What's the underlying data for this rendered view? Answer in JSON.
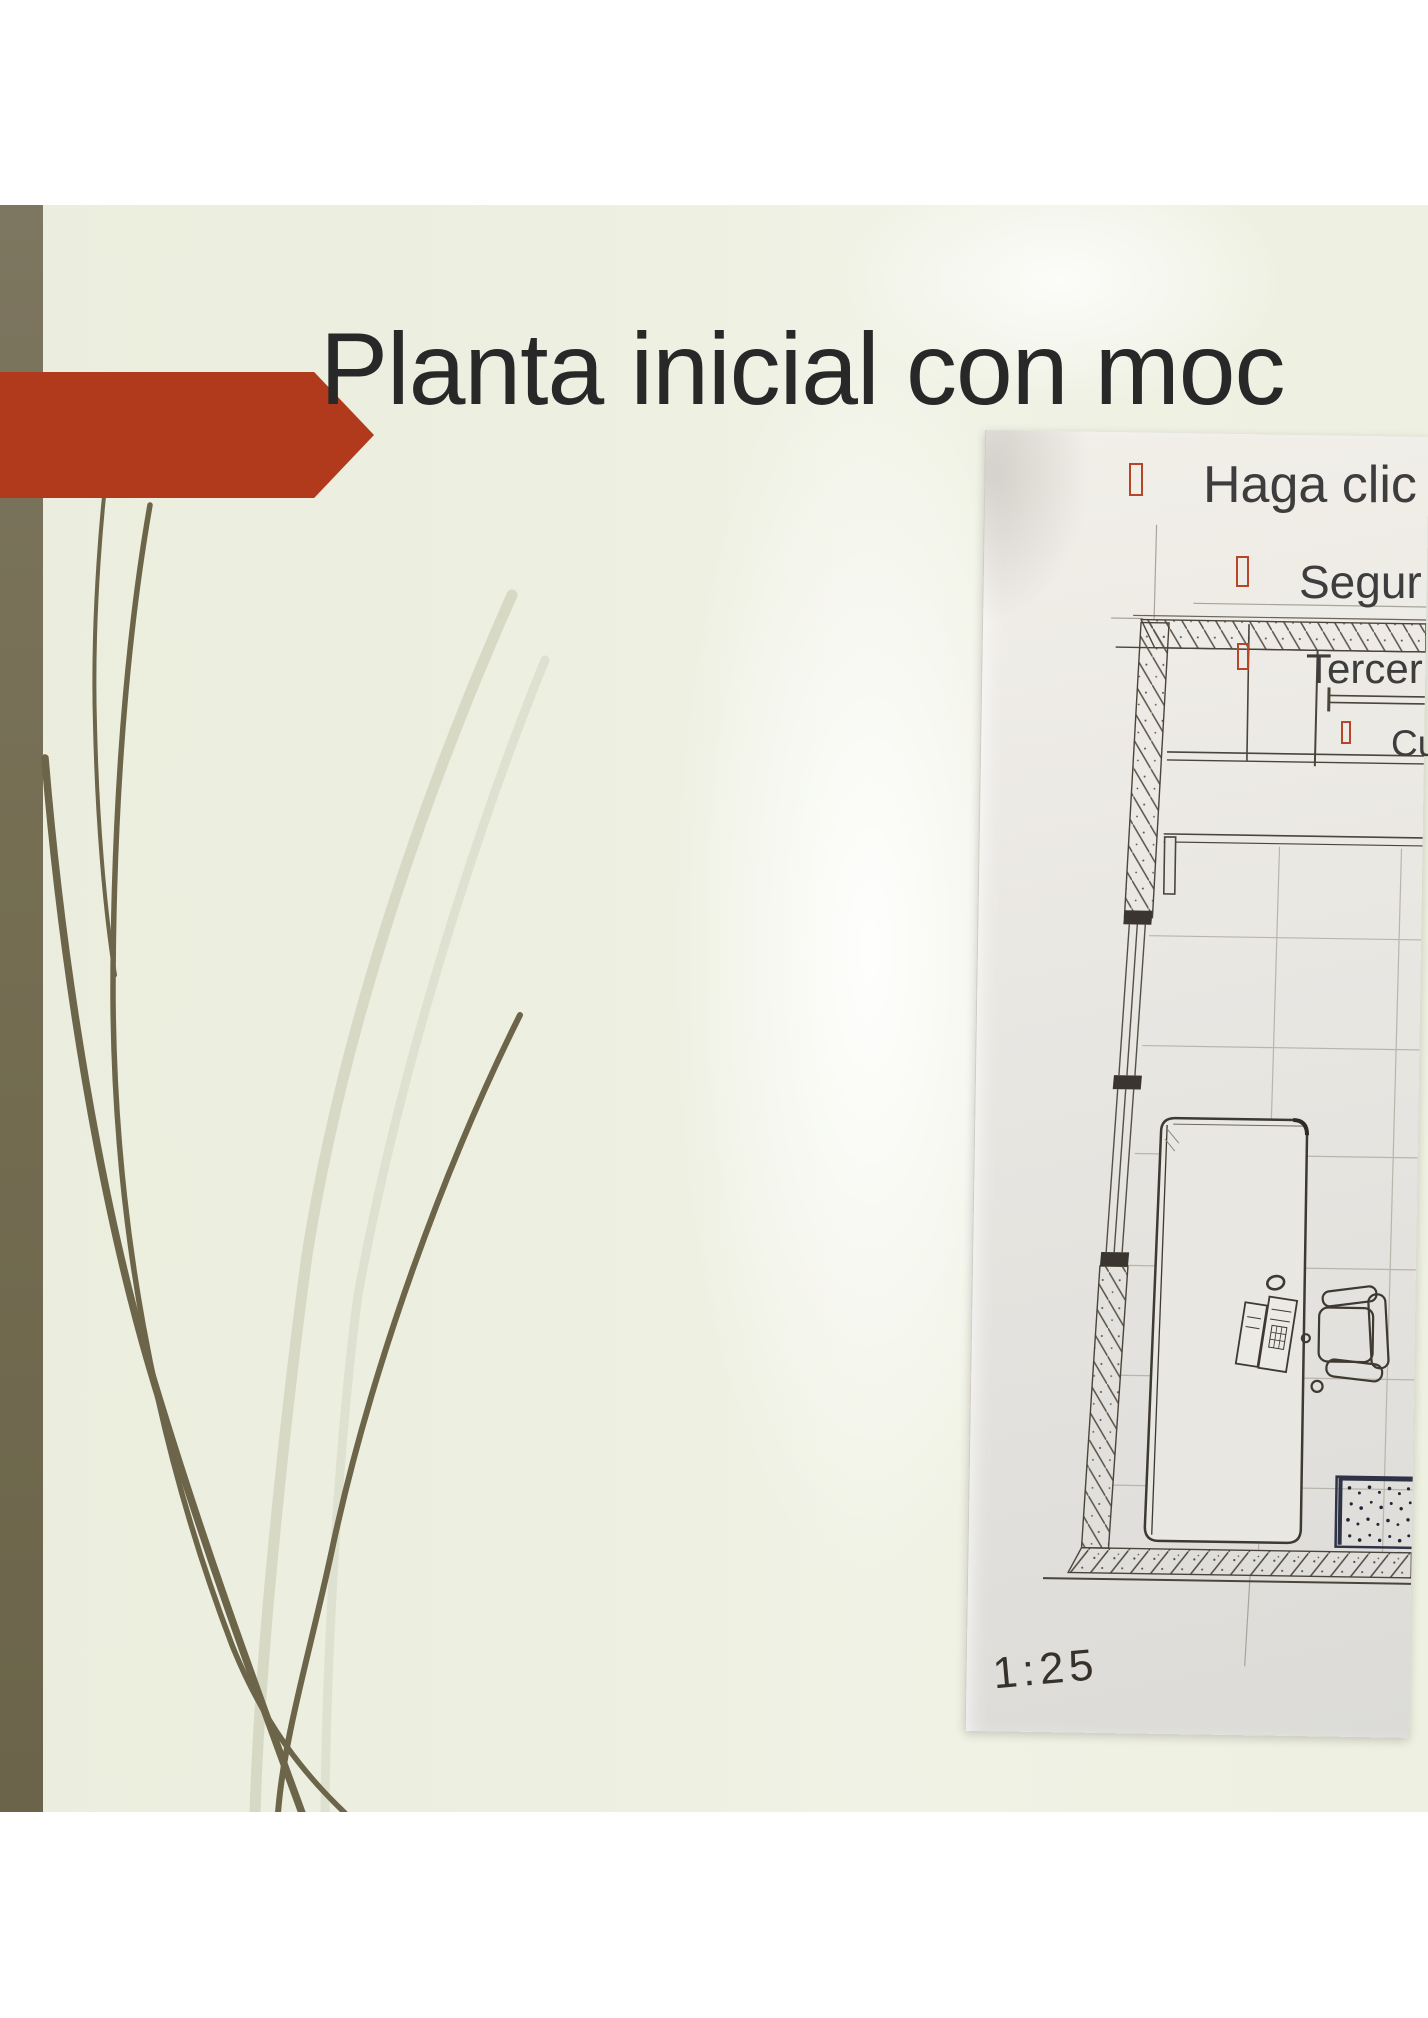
{
  "slide": {
    "title": "Planta inicial con moc",
    "bullets": [
      {
        "level": 1,
        "label": "Haga clic"
      },
      {
        "level": 2,
        "label": "Segur"
      },
      {
        "level": 3,
        "label": "Tercer"
      },
      {
        "level": 4,
        "label": "Cu"
      }
    ],
    "colors": {
      "title_text": "#282828",
      "body_text": "#3d3d3d",
      "bullet_box": "#b5462a",
      "arrow_red": "#b23a1c",
      "sidebar_olive": "#756e53",
      "background_cream": "#edefe0",
      "grass_dark": "#6c654a",
      "grass_light": "#d7d9c4"
    }
  },
  "photo": {
    "scale_label": "1:25",
    "colors": {
      "paper": "#e9e7e2",
      "ink": "#3e3931",
      "mat_ink": "#2e3346"
    }
  }
}
